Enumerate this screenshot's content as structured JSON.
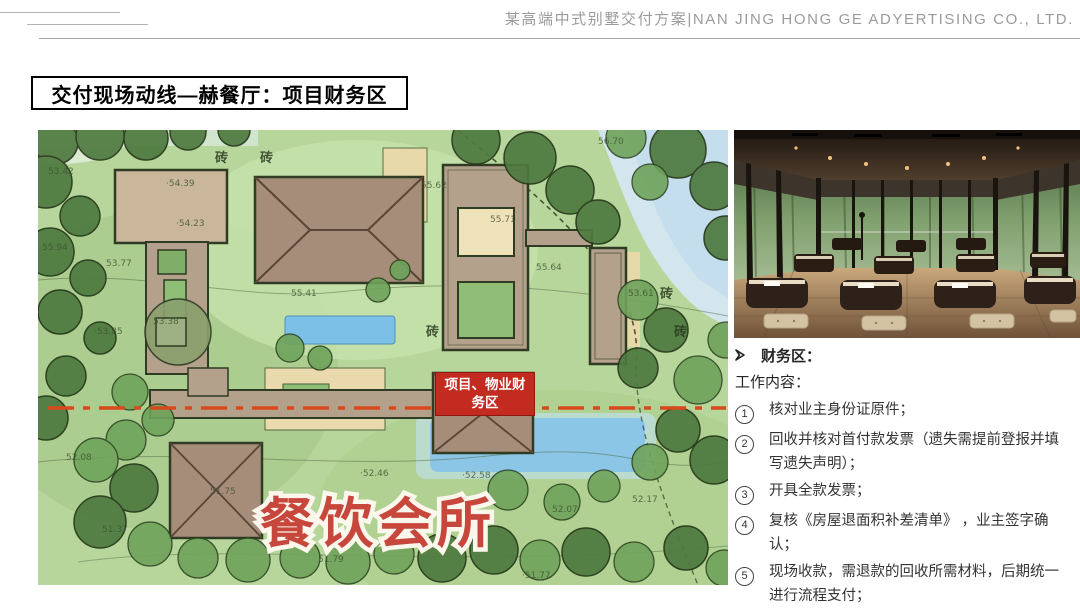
{
  "header": {
    "title": "某高端中式别墅交付方案|NAN JING HONG GE ADYERTISING CO., LTD."
  },
  "page": {
    "title": "交付现场动线—赫餐厅：项目财务区"
  },
  "map": {
    "big_label": "餐饮会所",
    "area_label": "项目、物业财务区",
    "brick_label": "砖",
    "elevations": [
      "53.42",
      "·54.39",
      "·54.23",
      "55.94",
      "53.77",
      "·53.85",
      "53.38",
      "55.41",
      "55.62",
      "55.71",
      "55.64",
      "56.70",
      "53.61",
      "52.08",
      "51.37",
      "51.75",
      "·52.46",
      "·52.58",
      "51.79",
      "52.07",
      "52.17",
      "·51.77"
    ],
    "colors": {
      "route_red": "#d9481c",
      "area_label_red": "#c32a20",
      "big_label_red": "#c8473c"
    }
  },
  "photo": {
    "description_icon": "interior-clubhouse-photo"
  },
  "panel": {
    "bullet_icon": "arrow-right-icon",
    "section_title": "财务区：",
    "subtitle": "工作内容：",
    "items": [
      {
        "num": "1",
        "text": "核对业主身份证原件；"
      },
      {
        "num": "2",
        "text": "回收并核对首付款发票（遗失需提前登报并填写遗失声明）；"
      },
      {
        "num": "3",
        "text": "开具全款发票；"
      },
      {
        "num": "4",
        "text": "复核《房屋退面积补差清单》 ，业主签字确认；"
      },
      {
        "num": "5",
        "text": "现场收款，需退款的回收所需材料，后期统一进行流程支付；"
      },
      {
        "num": "6",
        "text": "办理完毕后在《交付流程流转单》上签字；"
      }
    ]
  }
}
